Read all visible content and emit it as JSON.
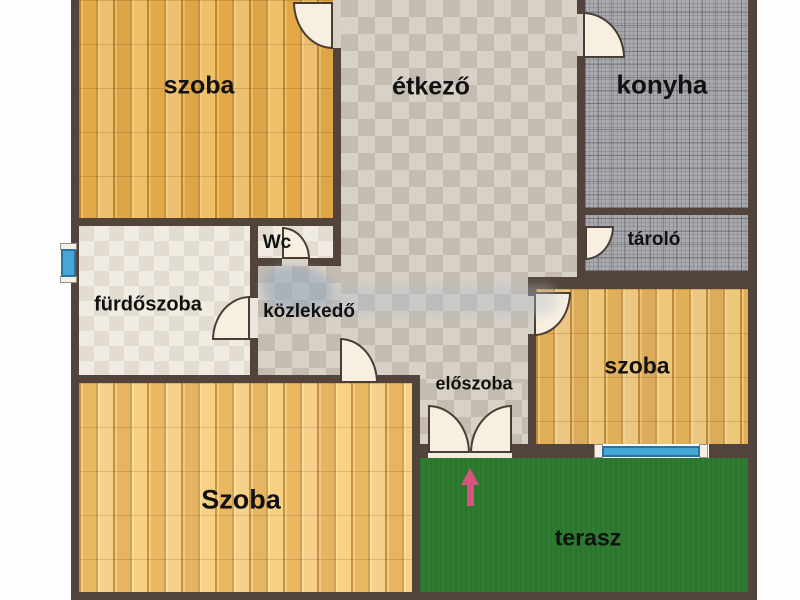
{
  "floorplan": {
    "labels": {
      "room_top_left": "szoba",
      "dining": "étkező",
      "kitchen": "konyha",
      "storage": "tároló",
      "wc": "Wc",
      "bathroom": "fürdőszoba",
      "hallway": "közlekedő",
      "entry_hall": "előszoba",
      "room_right": "szoba",
      "room_bottom": "Szoba",
      "terrace": "terasz"
    },
    "colors": {
      "wall": "#52443b",
      "wood_floor": "#e9bc69",
      "tile_light": "#d8d1c7",
      "tile_dark": "#c5bcb1",
      "bath_tile_light": "#f1ece3",
      "bath_tile_dark": "#e2dcd1",
      "kitchen_tile": "#a9aaad",
      "terrace_green": "#2e7b30",
      "window_blue": "#45a7d6",
      "door_fill": "#f7f0e1",
      "arrow_pink": "#d5537d",
      "label_text": "#111111"
    }
  }
}
